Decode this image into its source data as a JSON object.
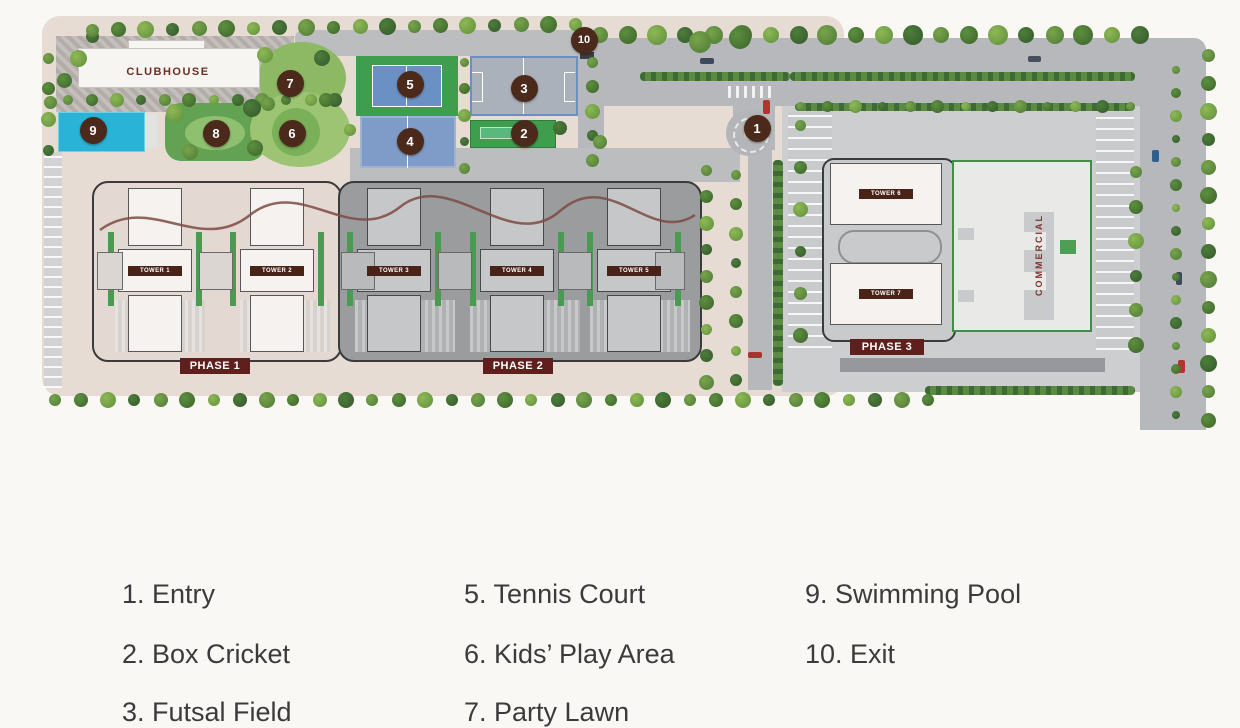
{
  "site_plan": {
    "clubhouse": {
      "label": "CLUBHOUSE"
    },
    "commercial": {
      "label": "COMMERCIAL"
    },
    "phases": [
      {
        "label": "PHASE 1"
      },
      {
        "label": "PHASE 2"
      },
      {
        "label": "PHASE 3"
      }
    ],
    "towers": [
      {
        "label": "TOWER 1"
      },
      {
        "label": "TOWER 2"
      },
      {
        "label": "TOWER 3"
      },
      {
        "label": "TOWER 4"
      },
      {
        "label": "TOWER 5"
      },
      {
        "label": "TOWER 6"
      },
      {
        "label": "TOWER 7"
      }
    ],
    "markers": [
      {
        "num": "1"
      },
      {
        "num": "2"
      },
      {
        "num": "3"
      },
      {
        "num": "4"
      },
      {
        "num": "5"
      },
      {
        "num": "6"
      },
      {
        "num": "7"
      },
      {
        "num": "8"
      },
      {
        "num": "9"
      },
      {
        "num": "10"
      }
    ],
    "colors": {
      "marker": "#4B2A1B",
      "phase_label": "#5E1F1D",
      "tower_label": "#4A2318",
      "pool_blue": "#29B4D7",
      "tennis_green": "#3F9E4D",
      "court_blue": "#7E9CC7",
      "site_beige": "#E7DCD4",
      "road_gray": "#B7B8BB",
      "map_text_maroon": "#6B2F26"
    }
  },
  "legend": {
    "items": [
      {
        "text": "1. Entry"
      },
      {
        "text": "2. Box Cricket"
      },
      {
        "text": "3. Futsal Field"
      },
      {
        "text": "5. Tennis Court"
      },
      {
        "text": "6. Kids’ Play Area"
      },
      {
        "text": "7. Party Lawn"
      },
      {
        "text": "9. Swimming Pool"
      },
      {
        "text": "10. Exit"
      }
    ]
  }
}
